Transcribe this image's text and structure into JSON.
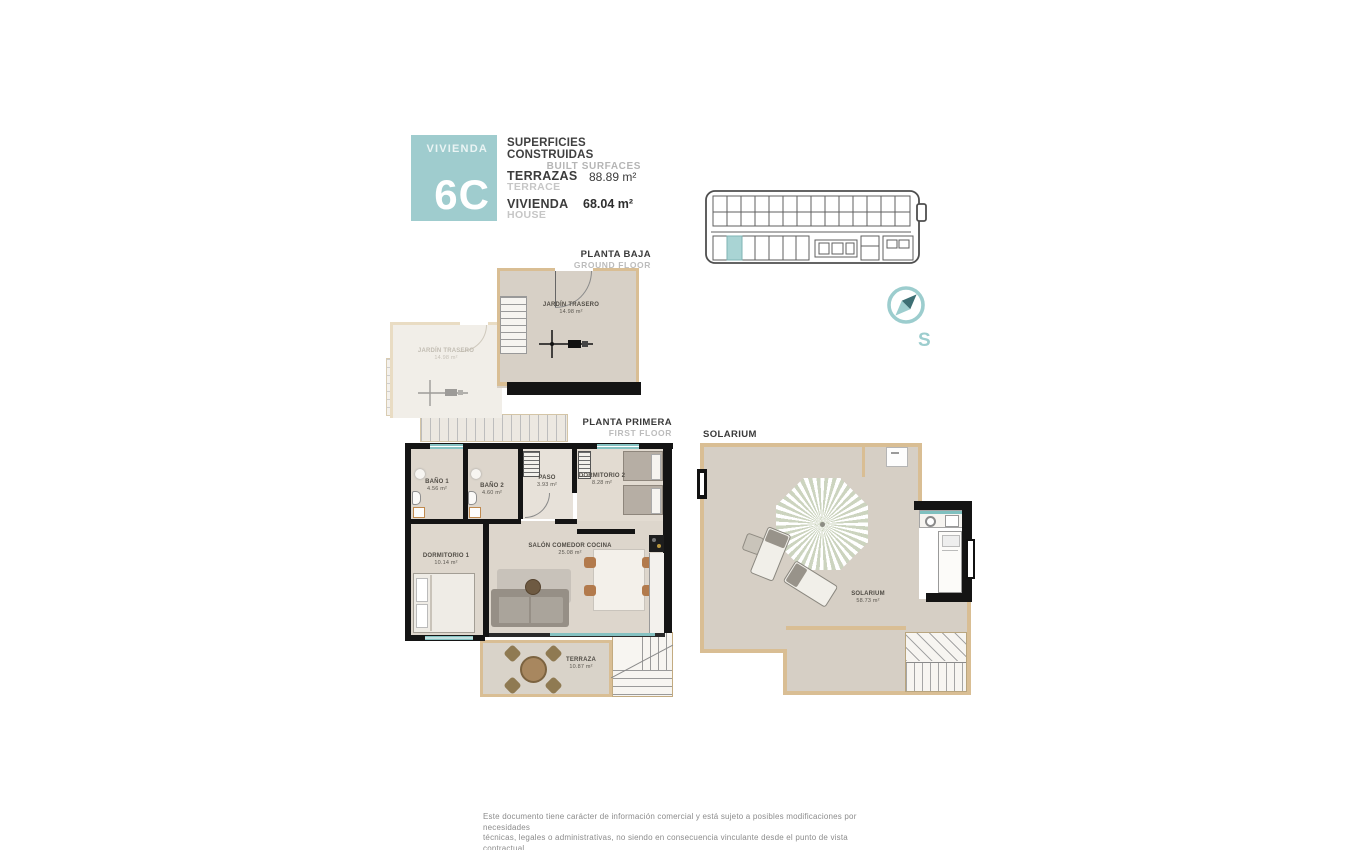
{
  "header": {
    "badge": {
      "label": "VIVIENDA",
      "number": "6C"
    },
    "surfaces": {
      "title": "SUPERFICIES CONSTRUIDAS",
      "subtitle": "BUILT SURFACES",
      "rows": [
        {
          "label": "TERRAZAS",
          "sublabel": "TERRACE",
          "value": "88.89 m²"
        },
        {
          "label": "VIVIENDA",
          "sublabel": "HOUSE",
          "value": "68.04 m²"
        }
      ]
    }
  },
  "compass": {
    "letter": "S"
  },
  "ground_floor": {
    "title": "PLANTA BAJA",
    "subtitle": "GROUND FLOOR",
    "garden": {
      "name": "JARDÍN TRASERO",
      "area": "14.98 m²"
    },
    "garden_adjacent": {
      "name": "JARDÍN TRASERO",
      "area": "14.98 m²"
    }
  },
  "first_floor": {
    "title": "PLANTA PRIMERA",
    "subtitle": "FIRST FLOOR",
    "rooms": {
      "bano1": {
        "name": "BAÑO 1",
        "area": "4.56 m²"
      },
      "bano2": {
        "name": "BAÑO 2",
        "area": "4.60 m²"
      },
      "paso": {
        "name": "PASO",
        "area": "3.93 m²"
      },
      "dormitorio2": {
        "name": "DORMITORIO 2",
        "area": "8.28 m²"
      },
      "dormitorio1": {
        "name": "DORMITORIO 1",
        "area": "10.14 m²"
      },
      "salon": {
        "name": "SALÓN COMEDOR COCINA",
        "area": "25.08 m²"
      },
      "terraza": {
        "name": "TERRAZA",
        "area": "10.87 m²"
      }
    }
  },
  "solarium_floor": {
    "title": "SOLARIUM",
    "room": {
      "name": "SOLARIUM",
      "area": "58.73 m²"
    }
  },
  "footer": {
    "line1": "Este documento tiene carácter de información comercial y está sujeto a posibles modificaciones por necesidades",
    "line2": "técnicas, legales o administrativas, no siendo en consecuencia vinculante desde el punto de vista contractual."
  },
  "colors": {
    "accent_teal": "#9fccce",
    "wall_tan": "#d9be94",
    "wall_black": "#141414",
    "window_teal": "#85c2c2",
    "floor_beige": "#d7d0c6",
    "highlight_unit": "#a9d4d4",
    "muted_gray": "#bcbcbc"
  }
}
